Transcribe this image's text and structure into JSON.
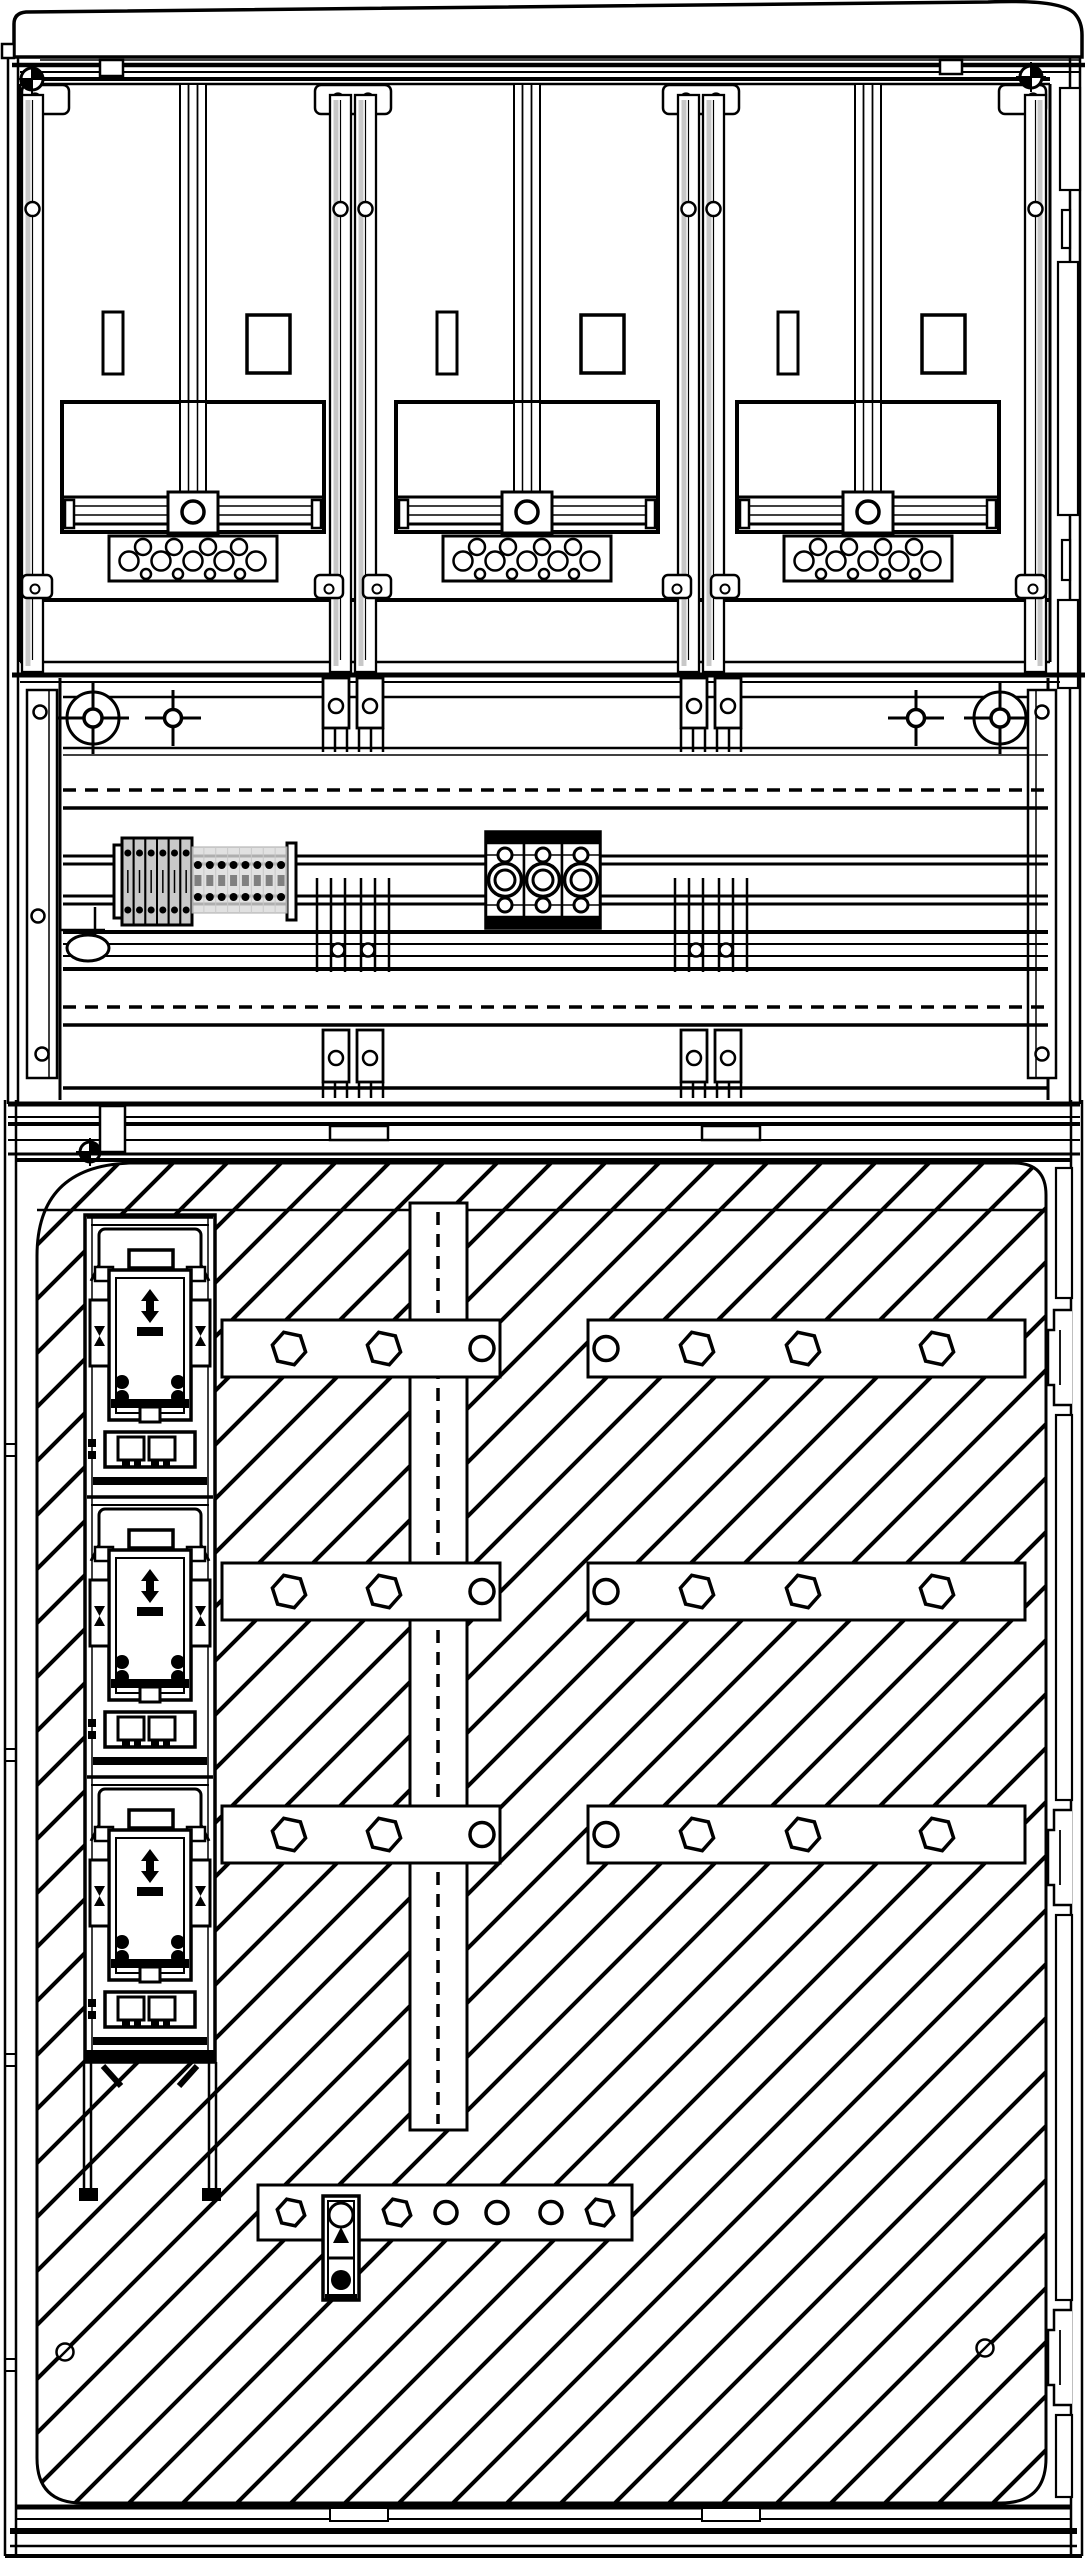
{
  "title": "meter-cabinet-technical-drawing",
  "canvas": {
    "width": 1087,
    "height": 2560
  },
  "colors": {
    "line": "#000000",
    "background": "#ffffff",
    "rail_shade": "#c8c8c8",
    "connector_fill": "#c9c9c9",
    "ghost_fill": "#d9d9d9",
    "screw_fill": "#808080"
  },
  "upper_section": {
    "bay_count": 3,
    "bay_centers": [
      193,
      527,
      868
    ],
    "divider_x": [
      353,
      701
    ],
    "edge_rail_x": [
      33,
      1035
    ],
    "rail_screw_y": [
      99,
      209
    ],
    "terminal_hole_rows": [
      {
        "y": 547,
        "r": 8,
        "offsets": [
          -50,
          -19,
          15,
          46
        ]
      },
      {
        "y": 561,
        "r": 9.5,
        "offsets": [
          -64,
          -32,
          0,
          31,
          63
        ]
      },
      {
        "y": 574,
        "r": 5,
        "offsets": [
          -47,
          -15,
          17,
          47
        ]
      }
    ],
    "cover_screws": [
      {
        "x": 32,
        "y": 79
      },
      {
        "x": 1031,
        "y": 77
      }
    ]
  },
  "middle_section": {
    "crosshairs": [
      {
        "x": 93,
        "y": 718,
        "type": "circled"
      },
      {
        "x": 173,
        "y": 718,
        "type": "plain"
      },
      {
        "x": 916,
        "y": 718,
        "type": "plain"
      },
      {
        "x": 1000,
        "y": 718,
        "type": "circled"
      }
    ],
    "column_x": [
      353,
      711
    ],
    "dashed_line_y": [
      790,
      1007
    ],
    "connector_block": {
      "x": 122,
      "y": 838,
      "width": 70,
      "height": 87,
      "segments": 6
    },
    "ghost_block": {
      "x": 192,
      "y": 847,
      "width": 95,
      "height": 66,
      "cols": 8,
      "rows": 3
    },
    "bus_terminal": {
      "x": 486,
      "y": 832,
      "module_width": 38,
      "height": 96,
      "modules": 3
    },
    "bracket_screws_left": [
      {
        "x": 40,
        "y": 712
      },
      {
        "x": 38,
        "y": 916
      },
      {
        "x": 42,
        "y": 1054
      }
    ],
    "bracket_screws_right": [
      {
        "x": 1042,
        "y": 712
      },
      {
        "x": 1042,
        "y": 1054
      }
    ]
  },
  "lower_section": {
    "hatch": {
      "spacing": 54,
      "stroke": 4
    },
    "seam_y": 1210,
    "center_strip": {
      "x": 410,
      "y": 1203,
      "width": 57,
      "height": 927
    },
    "fuse_switch_y": [
      1215,
      1495,
      1775
    ],
    "bolt_bars": [
      {
        "x": 222,
        "y": 1320,
        "w": 278,
        "h": 57,
        "fasteners": [
          {
            "t": "hex",
            "dx": 67,
            "r": 17
          },
          {
            "t": "hex",
            "dx": 162,
            "r": 17
          },
          {
            "t": "circle",
            "dx": 260,
            "r": 12
          }
        ]
      },
      {
        "x": 588,
        "y": 1320,
        "w": 437,
        "h": 57,
        "fasteners": [
          {
            "t": "circle",
            "dx": 18,
            "r": 12
          },
          {
            "t": "hex",
            "dx": 109,
            "r": 17
          },
          {
            "t": "hex",
            "dx": 215,
            "r": 17
          },
          {
            "t": "hex",
            "dx": 349,
            "r": 17
          }
        ]
      },
      {
        "x": 222,
        "y": 1563,
        "w": 278,
        "h": 57,
        "fasteners": [
          {
            "t": "hex",
            "dx": 67,
            "r": 17
          },
          {
            "t": "hex",
            "dx": 162,
            "r": 17
          },
          {
            "t": "circle",
            "dx": 260,
            "r": 12
          }
        ]
      },
      {
        "x": 588,
        "y": 1563,
        "w": 437,
        "h": 57,
        "fasteners": [
          {
            "t": "circle",
            "dx": 18,
            "r": 12
          },
          {
            "t": "hex",
            "dx": 109,
            "r": 17
          },
          {
            "t": "hex",
            "dx": 215,
            "r": 17
          },
          {
            "t": "hex",
            "dx": 349,
            "r": 17
          }
        ]
      },
      {
        "x": 222,
        "y": 1806,
        "w": 278,
        "h": 57,
        "fasteners": [
          {
            "t": "hex",
            "dx": 67,
            "r": 17
          },
          {
            "t": "hex",
            "dx": 162,
            "r": 17
          },
          {
            "t": "circle",
            "dx": 260,
            "r": 12
          }
        ]
      },
      {
        "x": 588,
        "y": 1806,
        "w": 437,
        "h": 57,
        "fasteners": [
          {
            "t": "circle",
            "dx": 18,
            "r": 12
          },
          {
            "t": "hex",
            "dx": 109,
            "r": 17
          },
          {
            "t": "hex",
            "dx": 215,
            "r": 17
          },
          {
            "t": "hex",
            "dx": 349,
            "r": 17
          }
        ]
      },
      {
        "x": 258,
        "y": 2185,
        "w": 374,
        "h": 55,
        "fasteners": [
          {
            "t": "hex",
            "dx": 33,
            "r": 14
          },
          {
            "t": "hex",
            "dx": 139,
            "r": 14
          },
          {
            "t": "circle",
            "dx": 188,
            "r": 11
          },
          {
            "t": "circle",
            "dx": 239,
            "r": 11
          },
          {
            "t": "circle",
            "dx": 293,
            "r": 11
          },
          {
            "t": "hex",
            "dx": 342,
            "r": 14
          }
        ]
      }
    ],
    "slash_screws": [
      {
        "x": 65,
        "y": 2352
      },
      {
        "x": 985,
        "y": 2348
      }
    ],
    "hinge_y": [
      1310,
      1810,
      2310
    ]
  }
}
